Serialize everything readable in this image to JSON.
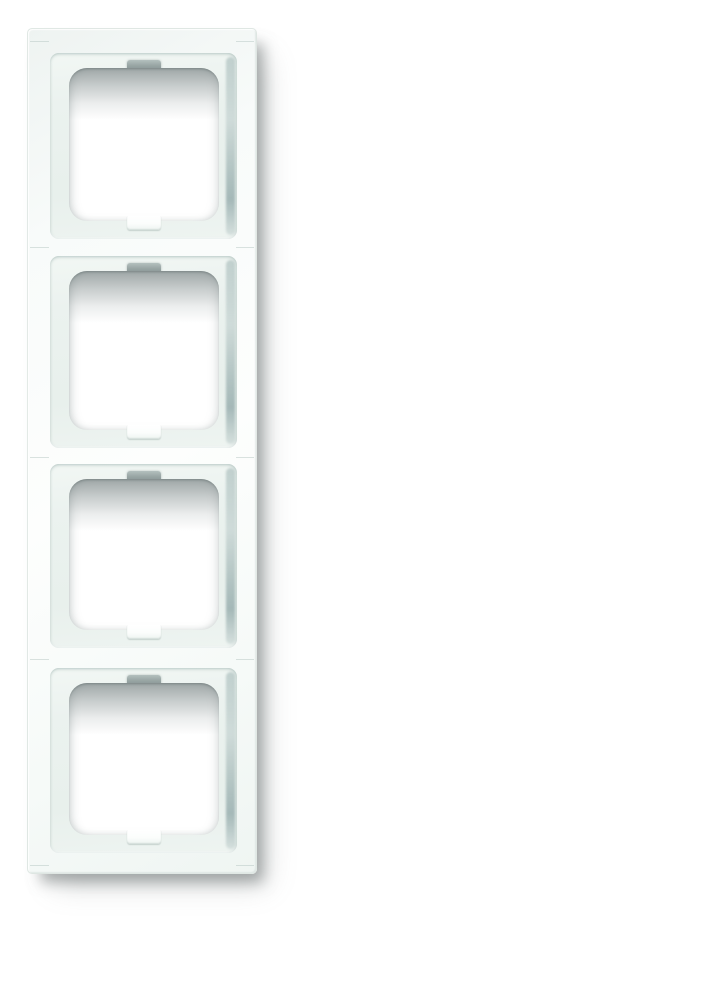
{
  "scene": {
    "type": "product-photo",
    "subject": "White vertical 4-gang electrical cover frame (switch/socket frame) photographed on a plain white background with a soft drop shadow cast to the lower right",
    "background_color": "#ffffff"
  },
  "frame": {
    "gang_count": 4,
    "orientation": "vertical",
    "cells": [
      {
        "name": "gang-1"
      },
      {
        "name": "gang-2"
      },
      {
        "name": "gang-3"
      },
      {
        "name": "gang-4"
      }
    ]
  },
  "colors": {
    "background": "#ffffff",
    "frame_face": "#f9fbfa",
    "frame_edge": "#dde5e1",
    "recess_fill": "#ebf2ee",
    "recess_teal_edge": "#6f8a8c",
    "opening_fill": "#ffffff",
    "opening_inner_shadow": "#647171",
    "claw_gray": "#8c9998",
    "notch_white": "#fbfdfc",
    "drop_shadow": "#8f9898"
  }
}
